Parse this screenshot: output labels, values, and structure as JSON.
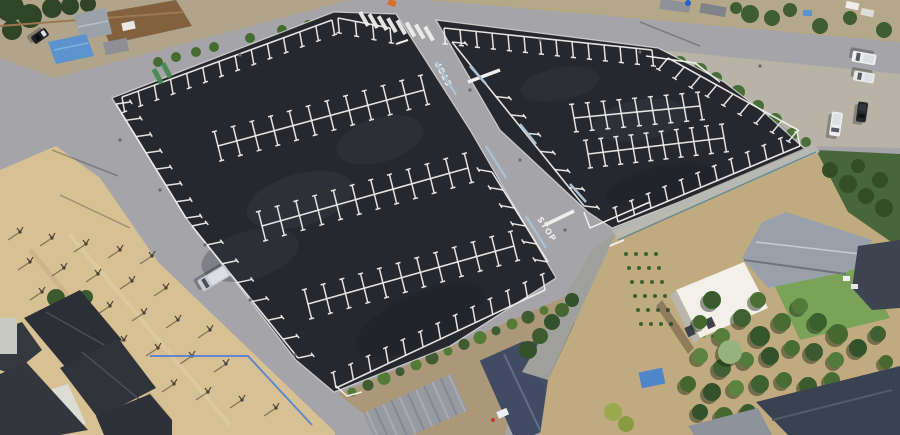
{
  "scene": {
    "markings": {
      "stop_top": "STOP",
      "stop_bottom": "STOP"
    }
  },
  "palette": {
    "asphalt": "#26282e",
    "road": "#a5a5a9",
    "marking": "#f0efec",
    "sand": "#d7c194",
    "gravel": "#b7b3a7",
    "vegetation": "#44622f",
    "roof_dark": "#323640",
    "roof_gray": "#9aa0a9",
    "tarp_blue": "#5b93cc",
    "fence_blue": "#3f6fd0"
  }
}
